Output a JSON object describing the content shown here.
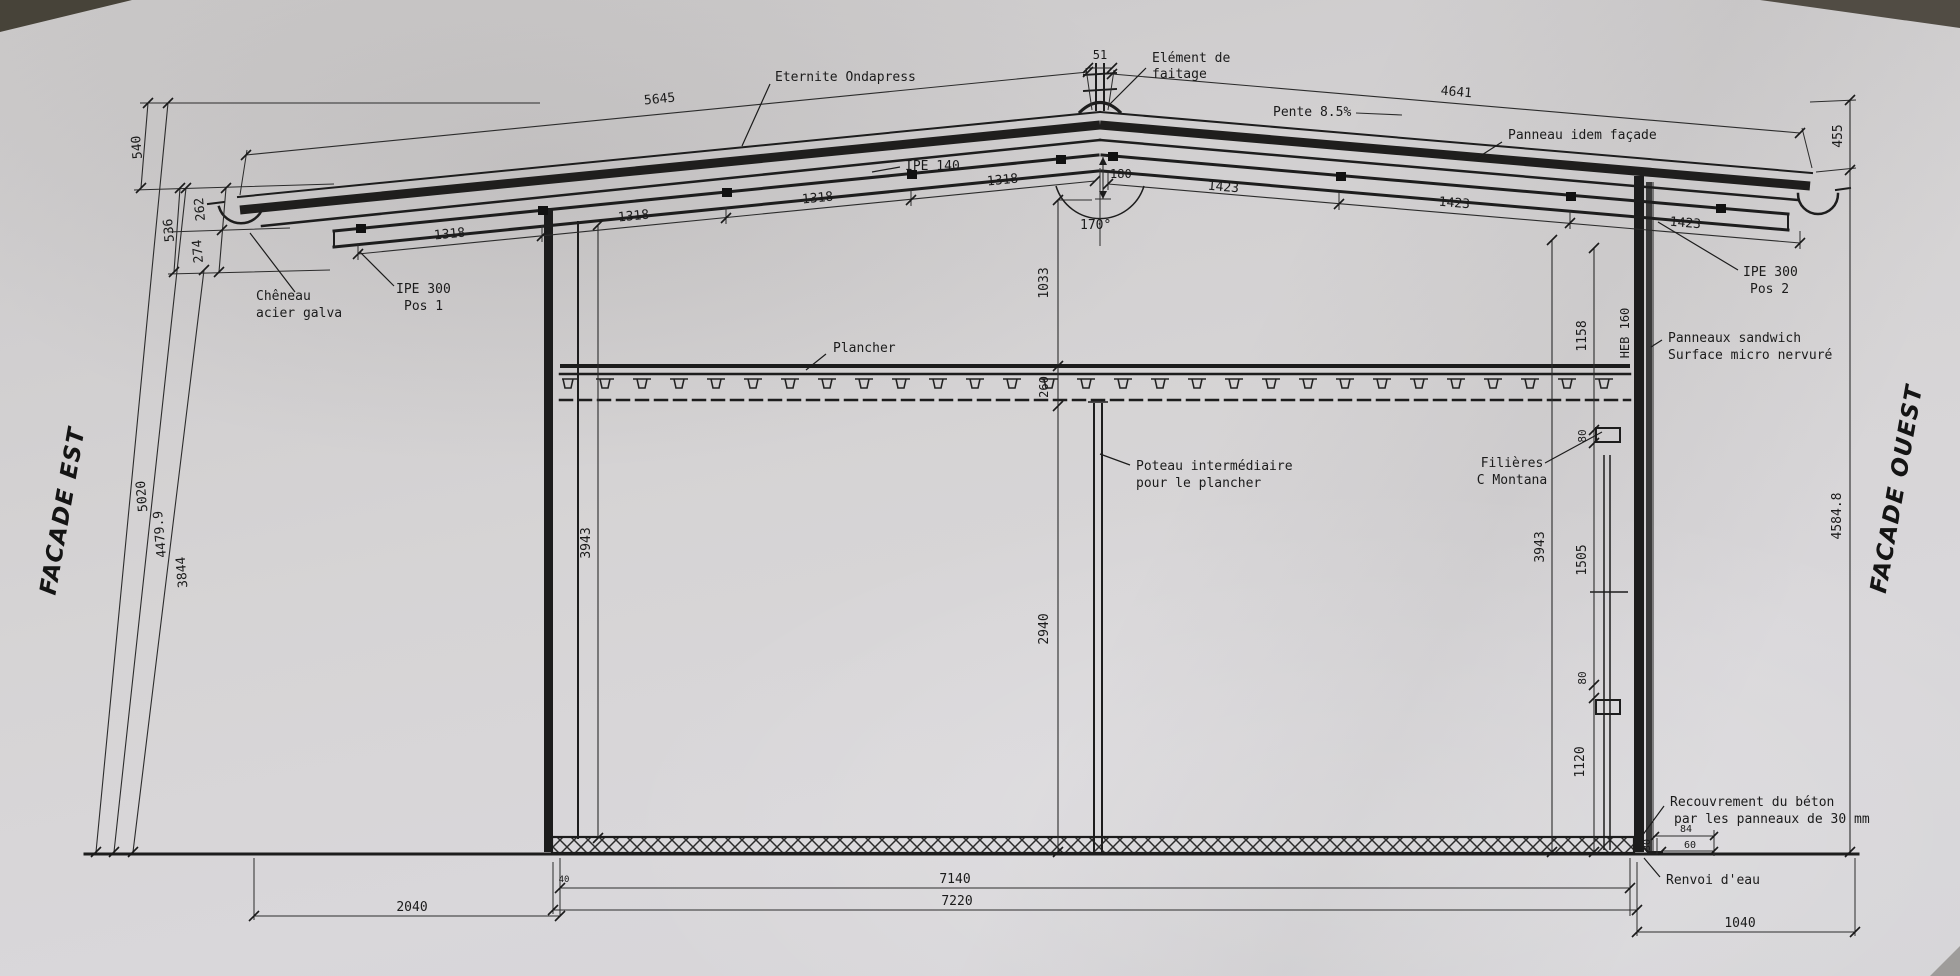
{
  "facades": {
    "east": "FACADE EST",
    "west": "FACADE OUEST"
  },
  "labels": {
    "roof_covering": "Eternite Ondapress",
    "ridge_element_1": "Elément de",
    "ridge_element_2": "faitage",
    "slope": "Pente 8.5%",
    "roof_panel": "Panneau idem façade",
    "purlin": "IPE 140",
    "rafter_left_1": "IPE 300",
    "rafter_left_2": "Pos 1",
    "rafter_right_1": "IPE 300",
    "rafter_right_2": "Pos 2",
    "gutter_1": "Chêneau",
    "gutter_2": "acier galva",
    "wall_panel_1": "Panneaux sandwich",
    "wall_panel_2": "Surface micro nervuré",
    "floor": "Plancher",
    "mid_column_1": "Poteau intermédiaire",
    "mid_column_2": "pour le plancher",
    "girts_1": "Filières",
    "girts_2": "C Montana",
    "column_profile": "HEB 160",
    "concrete_cover_1": "Recouvrement du béton",
    "concrete_cover_2": "par les panneaux de 30 mm",
    "drip": "Renvoi d'eau"
  },
  "dims": {
    "roof_left": "5645",
    "roof_right": "4641",
    "ridge_width": "51",
    "ridge_rise": "180",
    "ridge_angle": "170°",
    "bay_left": [
      "1318",
      "1318",
      "1318",
      "1318"
    ],
    "bay_right": [
      "1423",
      "1423",
      "1423"
    ],
    "left_top": "540",
    "left_a": "262",
    "left_ab": "536",
    "left_b": "274",
    "left_total": "5020",
    "left_eave": "4479.9",
    "left_inner": "3844",
    "left_clear": "3943",
    "right_top": "455",
    "right_total": "4584.8",
    "right_upper": "1158",
    "right_gap1": "80",
    "right_mid": "1505",
    "right_gap2": "80",
    "right_lower": "1120",
    "right_clear": "3943",
    "ridge_to_floor": "1033",
    "floor_thk": "260",
    "floor_to_ground": "2940",
    "span_inner": "7140",
    "span_outer": "7220",
    "offset_left": "2040",
    "offset_right": "1040",
    "detail_top": "84",
    "detail_mid": "30",
    "detail_bot": "60",
    "slab_edge": "40"
  }
}
